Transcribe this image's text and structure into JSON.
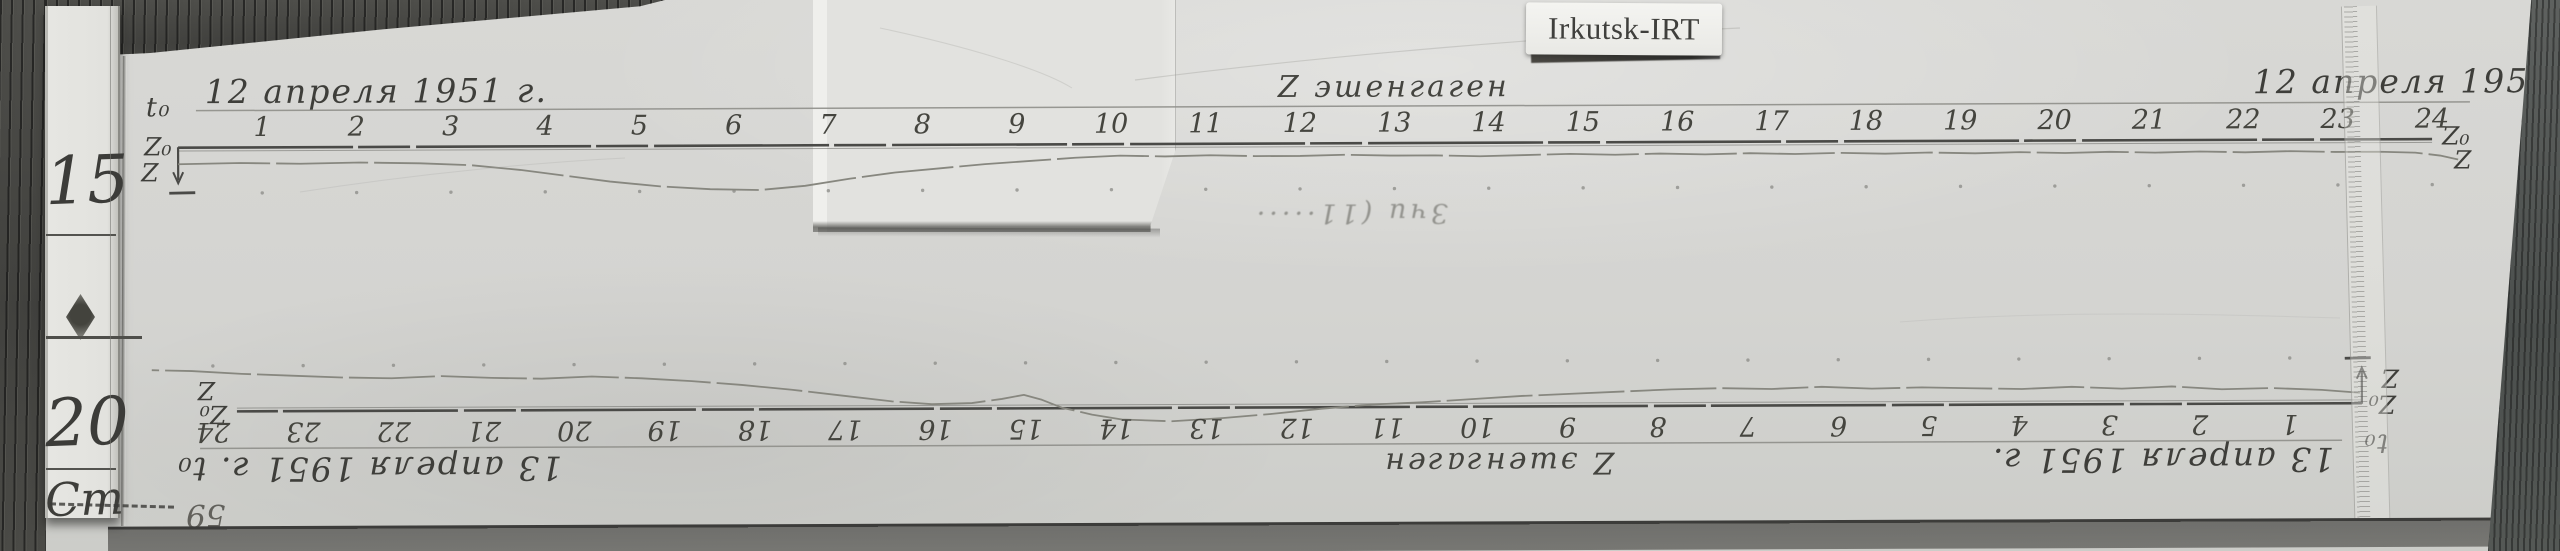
{
  "sticker": {
    "text": "Irkutsk-IRT"
  },
  "ruler": {
    "mark_top": "15",
    "mark_bottom": "20",
    "unit": "Cm"
  },
  "records": [
    {
      "t0": "t₀",
      "date": "12 апреля 1951 г.",
      "z0": "Z₀",
      "z": "Z",
      "instrument": "Z эшенгаген",
      "hours": [
        "1",
        "2",
        "3",
        "4",
        "5",
        "6",
        "7",
        "8",
        "9",
        "10",
        "11",
        "12",
        "13",
        "14",
        "15",
        "16",
        "17",
        "18",
        "19",
        "20",
        "21",
        "22",
        "23",
        "24"
      ],
      "trace": [
        [
          178,
          16
        ],
        [
          240,
          15
        ],
        [
          300,
          16
        ],
        [
          360,
          15
        ],
        [
          420,
          16
        ],
        [
          470,
          18
        ],
        [
          520,
          23
        ],
        [
          565,
          29
        ],
        [
          610,
          35
        ],
        [
          660,
          40
        ],
        [
          710,
          43
        ],
        [
          760,
          44
        ],
        [
          805,
          40
        ],
        [
          850,
          33
        ],
        [
          895,
          27
        ],
        [
          940,
          23
        ],
        [
          985,
          19
        ],
        [
          1030,
          16
        ],
        [
          1075,
          13
        ],
        [
          1120,
          11
        ],
        [
          1165,
          12
        ],
        [
          1210,
          11
        ],
        [
          1255,
          12
        ],
        [
          1300,
          12
        ],
        [
          1345,
          11
        ],
        [
          1390,
          12
        ],
        [
          1435,
          12
        ],
        [
          1480,
          13
        ],
        [
          1525,
          12
        ],
        [
          1570,
          11
        ],
        [
          1615,
          12
        ],
        [
          1660,
          11
        ],
        [
          1705,
          12
        ],
        [
          1750,
          11
        ],
        [
          1795,
          12
        ],
        [
          1840,
          11
        ],
        [
          1885,
          12
        ],
        [
          1930,
          11
        ],
        [
          1975,
          12
        ],
        [
          2020,
          11
        ],
        [
          2065,
          12
        ],
        [
          2110,
          11
        ],
        [
          2155,
          12
        ],
        [
          2200,
          11
        ],
        [
          2245,
          12
        ],
        [
          2290,
          11
        ],
        [
          2335,
          12
        ],
        [
          2380,
          12
        ],
        [
          2415,
          13
        ],
        [
          2440,
          16
        ],
        [
          2458,
          20
        ]
      ]
    },
    {
      "t0": "t₀",
      "date": "13 апреля 1951 г.",
      "z0": "Z₀",
      "z": "Z",
      "instrument": "Z эшенгаген",
      "hours": [
        "1",
        "2",
        "3",
        "4",
        "5",
        "6",
        "7",
        "8",
        "9",
        "10",
        "11",
        "12",
        "13",
        "14",
        "15",
        "16",
        "17",
        "18",
        "19",
        "20",
        "21",
        "22",
        "23",
        "24"
      ],
      "trace": [
        [
          132,
          10
        ],
        [
          170,
          13
        ],
        [
          220,
          15
        ],
        [
          270,
          14
        ],
        [
          320,
          17
        ],
        [
          370,
          15
        ],
        [
          420,
          17
        ],
        [
          470,
          15
        ],
        [
          520,
          16
        ],
        [
          570,
          17
        ],
        [
          620,
          16
        ],
        [
          670,
          18
        ],
        [
          720,
          16
        ],
        [
          770,
          17
        ],
        [
          820,
          16
        ],
        [
          870,
          14
        ],
        [
          920,
          12
        ],
        [
          970,
          10
        ],
        [
          1020,
          7
        ],
        [
          1070,
          4
        ],
        [
          1120,
          2
        ],
        [
          1170,
          -2
        ],
        [
          1220,
          -7
        ],
        [
          1270,
          -11
        ],
        [
          1320,
          -14
        ],
        [
          1370,
          -12
        ],
        [
          1400,
          -7
        ],
        [
          1430,
          0
        ],
        [
          1450,
          8
        ],
        [
          1468,
          13
        ],
        [
          1490,
          9
        ],
        [
          1520,
          5
        ],
        [
          1560,
          4
        ],
        [
          1600,
          7
        ],
        [
          1650,
          13
        ],
        [
          1700,
          19
        ],
        [
          1750,
          24
        ],
        [
          1800,
          28
        ],
        [
          1850,
          31
        ],
        [
          1900,
          33
        ],
        [
          1950,
          31
        ],
        [
          2000,
          32
        ],
        [
          2050,
          34
        ],
        [
          2100,
          32
        ],
        [
          2150,
          33
        ],
        [
          2200,
          35
        ],
        [
          2250,
          37
        ],
        [
          2300,
          40
        ],
        [
          2340,
          41
        ]
      ]
    }
  ],
  "notes": {
    "pencil_note": "Зчи (11·····",
    "corner_number": "59"
  }
}
